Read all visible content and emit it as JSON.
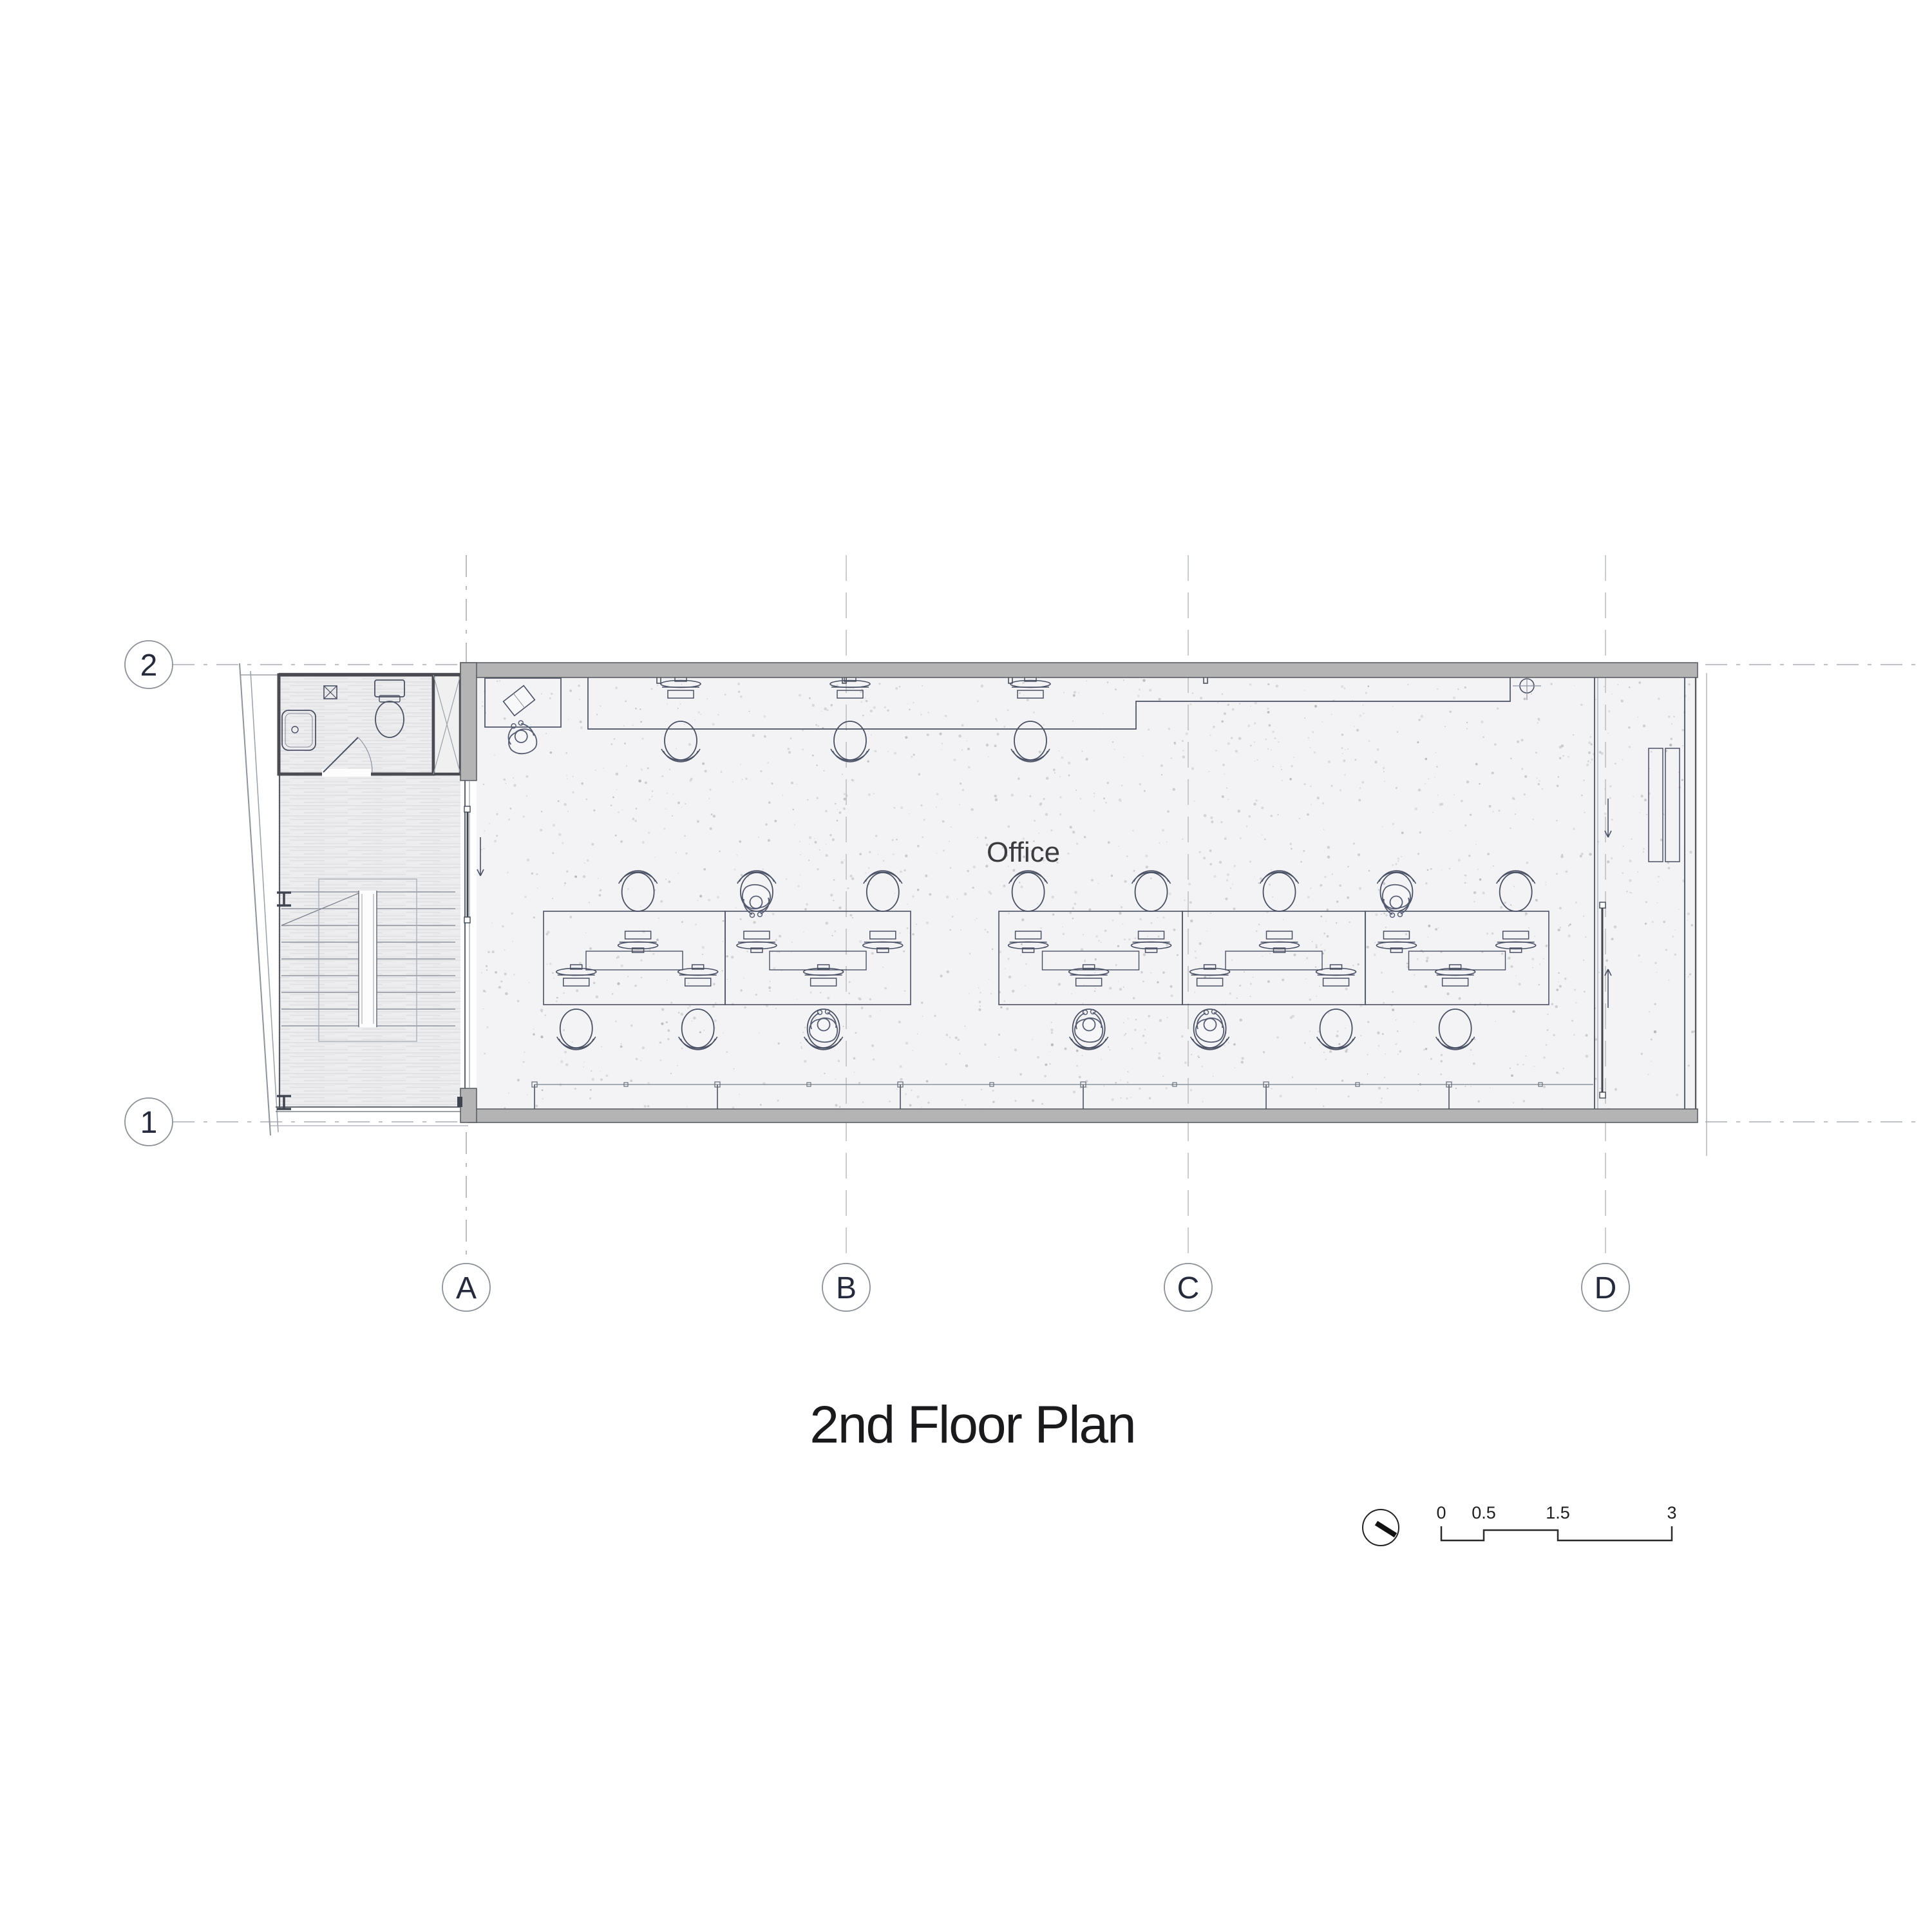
{
  "sheet": {
    "title": "2nd Floor Plan",
    "drawing_type": "floor plan"
  },
  "rooms": {
    "office_label": "Office"
  },
  "grid": {
    "columns": [
      "A",
      "B",
      "C",
      "D"
    ],
    "rows": [
      "2",
      "1"
    ]
  },
  "scale_bar": {
    "tick_labels": [
      "0",
      "0.5",
      "1.5",
      "3"
    ]
  },
  "symbols": {
    "north_indicator": "north-arrow-circle",
    "survey_point": "circle-cross-marker"
  },
  "colors": {
    "wall_fill": "#b4b4b4",
    "wall_edge": "#55585f",
    "line_dark": "#4a5064",
    "floor_speckle": "#c2c2c7",
    "grid_line": "#a9adb5",
    "annex_floor": "#ededef"
  }
}
